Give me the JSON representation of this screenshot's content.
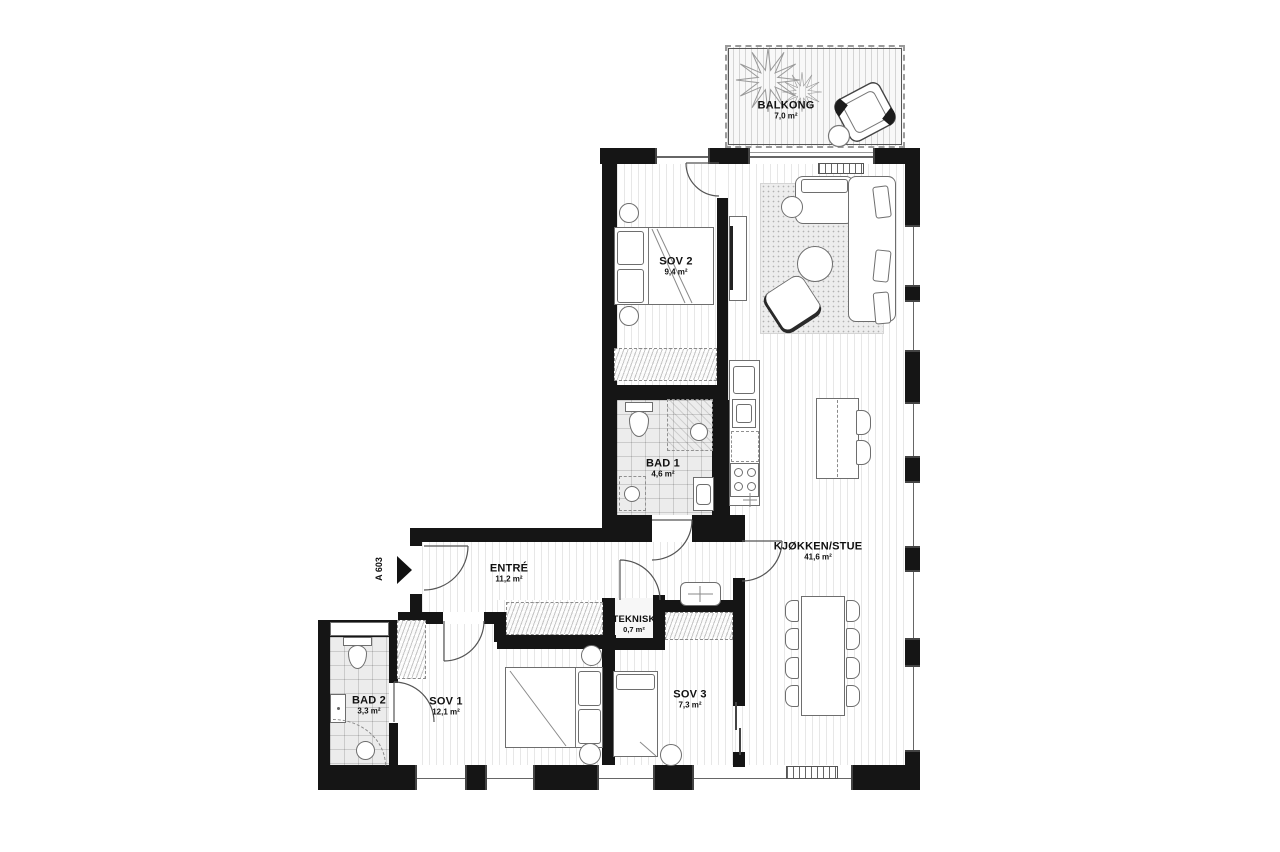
{
  "unit": {
    "label": "A 603"
  },
  "rooms": {
    "balkong": {
      "name": "BALKONG",
      "area": "7,0 m²"
    },
    "sov2": {
      "name": "SOV 2",
      "area": "9,4 m²"
    },
    "bad1": {
      "name": "BAD 1",
      "area": "4,6 m²"
    },
    "kjokken": {
      "name": "KJØKKEN/STUE",
      "area": "41,6 m²"
    },
    "entre": {
      "name": "ENTRÉ",
      "area": "11,2 m²"
    },
    "teknisk": {
      "name": "TEKNISK",
      "area": "0,7 m²"
    },
    "sov1": {
      "name": "SOV 1",
      "area": "12,1 m²"
    },
    "sov3": {
      "name": "SOV 3",
      "area": "7,3 m²"
    },
    "bad2": {
      "name": "BAD 2",
      "area": "3,3 m²"
    }
  },
  "colors": {
    "wall": "#151515",
    "furniture_stroke": "#6e6e6e",
    "tile_bg": "#ececec"
  }
}
